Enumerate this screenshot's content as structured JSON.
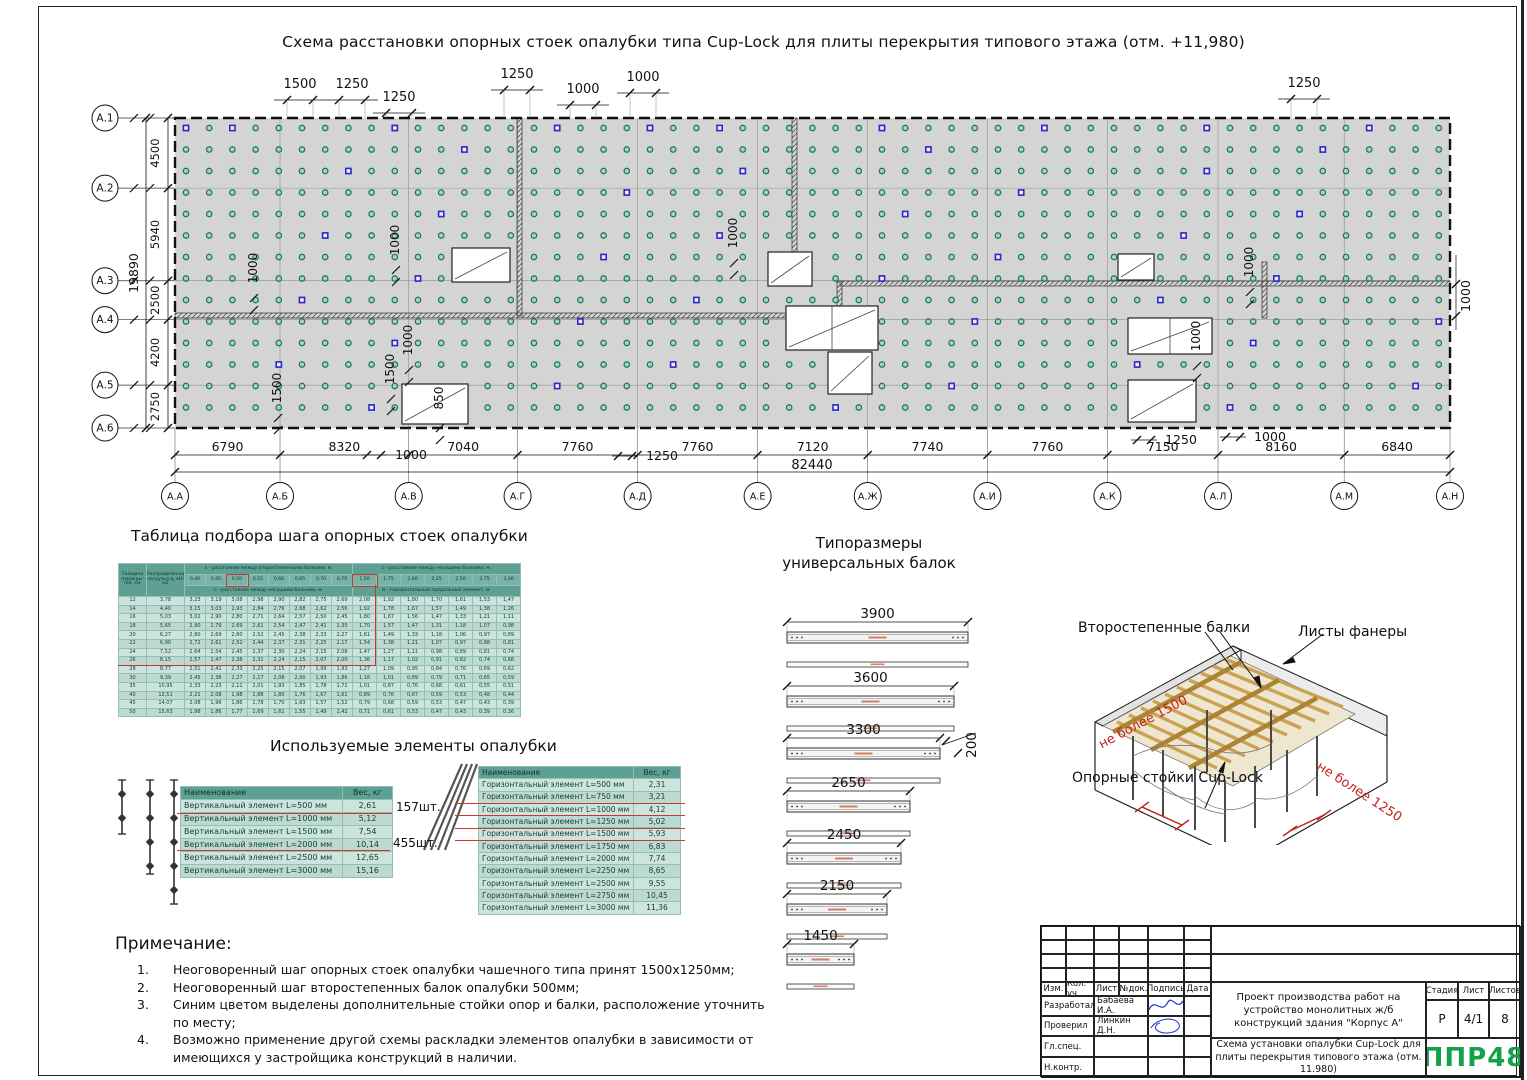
{
  "sheet": {
    "title": "Схема расстановки опорных стоек опалубки типа Cup-Lock для плиты перекрытия типового этажа (отм. +11,980)"
  },
  "colors": {
    "plate_gray": "#d4d4d2",
    "support_green_stroke": "#1f7a58",
    "support_green_fill": "#a8d4c2",
    "extra_blue": "#2a2ac8",
    "table_header": "#5fa095",
    "highlight_red": "#c23b2e",
    "logo_green": "#15a04a"
  },
  "plan": {
    "col_labels": [
      "А.А",
      "А.Б",
      "А.В",
      "А.Г",
      "А.Д",
      "А.Е",
      "А.Ж",
      "А.И",
      "А.К",
      "А.Л",
      "А.М",
      "А.Н"
    ],
    "col_spans": [
      "6790",
      "8320",
      "7040",
      "7760",
      "7760",
      "7120",
      "7740",
      "7760",
      "7150",
      "8160",
      "6840"
    ],
    "total_width": "82440",
    "row_labels": [
      "А.1",
      "А.2",
      "А.3",
      "А.4",
      "А.5",
      "А.6"
    ],
    "row_spans": [
      "4500",
      "5940",
      "2500",
      "4200",
      "2750"
    ],
    "total_height": "19890",
    "top_dims": [
      {
        "label": "1500",
        "x": 300,
        "y": 88
      },
      {
        "label": "1250",
        "x": 352,
        "y": 88
      },
      {
        "label": "1250",
        "x": 399,
        "y": 101
      },
      {
        "label": "1250",
        "x": 517,
        "y": 78
      },
      {
        "label": "1000",
        "x": 583,
        "y": 93
      },
      {
        "label": "1000",
        "x": 643,
        "y": 81
      },
      {
        "label": "1250",
        "x": 1304,
        "y": 87
      }
    ],
    "inner_dims": [
      {
        "label": "1000",
        "x": 257,
        "y": 268
      },
      {
        "label": "1000",
        "x": 399,
        "y": 240
      },
      {
        "label": "1000",
        "x": 412,
        "y": 340
      },
      {
        "label": "1000",
        "x": 737,
        "y": 233
      },
      {
        "label": "1000",
        "x": 1253,
        "y": 262
      },
      {
        "label": "1000",
        "x": 1200,
        "y": 336
      },
      {
        "label": "1500",
        "x": 281,
        "y": 388
      },
      {
        "label": "1500",
        "x": 394,
        "y": 369
      },
      {
        "label": "850",
        "x": 443,
        "y": 398
      }
    ],
    "bottom_callouts": [
      {
        "label": "1000",
        "x": 397,
        "y": 451
      },
      {
        "label": "1250",
        "x": 648,
        "y": 452
      },
      {
        "label": "1250",
        "x": 1167,
        "y": 436
      },
      {
        "label": "1000",
        "x": 1256,
        "y": 433
      }
    ],
    "right_dim": "1000"
  },
  "step_table": {
    "title": "Таблица подбора шага опорных стоек опалубки",
    "head_col1": "Толщина перекры- тия, см.",
    "head_col2": "Распределенная нагрузка q, кН/ м2",
    "group_a": "a -  расстояние между второстепенными балками, м.",
    "group_c": "c -  расстояние между несущими балками, м.",
    "sub_a": "c - расстояние между несущими балками, м.",
    "sub_c": "b - горизонтальный продольный элемент, м.",
    "a_cols": [
      "0,40",
      "0,45",
      "0,50",
      "0,55",
      "0,60",
      "0,65",
      "0,70",
      "0,75"
    ],
    "c_cols": [
      "1,50",
      "1,75",
      "2,00",
      "2,25",
      "2,50",
      "2,75",
      "3,00"
    ],
    "rows": [
      {
        "t": "12",
        "q": "3,78",
        "a": [
          "3,23",
          "3,19",
          "3,08",
          "2,98",
          "2,90",
          "2,82",
          "2,75",
          "2,69"
        ],
        "c": [
          "2,08",
          "1,92",
          "1,80",
          "1,70",
          "1,61",
          "1,53",
          "1,47"
        ]
      },
      {
        "t": "14",
        "q": "4,40",
        "a": [
          "3,15",
          "3,03",
          "2,93",
          "2,84",
          "2,76",
          "2,68",
          "2,62",
          "2,56"
        ],
        "c": [
          "1,92",
          "1,78",
          "1,67",
          "1,57",
          "1,49",
          "1,38",
          "1,26"
        ]
      },
      {
        "t": "16",
        "q": "5,03",
        "a": [
          "3,02",
          "2,90",
          "2,80",
          "2,71",
          "2,64",
          "2,57",
          "2,50",
          "2,45"
        ],
        "c": [
          "1,80",
          "1,67",
          "1,56",
          "1,47",
          "1,33",
          "1,21",
          "1,11"
        ]
      },
      {
        "t": "18",
        "q": "5,65",
        "a": [
          "2,90",
          "2,79",
          "2,69",
          "2,61",
          "2,54",
          "2,47",
          "2,41",
          "2,35"
        ],
        "c": [
          "1,70",
          "1,57",
          "1,47",
          "1,31",
          "1,18",
          "1,07",
          "0,98"
        ]
      },
      {
        "t": "20",
        "q": "6,27",
        "a": [
          "2,80",
          "2,69",
          "2,60",
          "2,52",
          "2,45",
          "2,38",
          "2,33",
          "2,27"
        ],
        "c": [
          "1,61",
          "1,49",
          "1,33",
          "1,18",
          "1,06",
          "0,97",
          "0,89"
        ]
      },
      {
        "t": "22",
        "q": "6,90",
        "a": [
          "2,72",
          "2,61",
          "2,52",
          "2,44",
          "2,37",
          "2,31",
          "2,25",
          "2,17"
        ],
        "c": [
          "1,54",
          "1,38",
          "1,21",
          "1,07",
          "0,97",
          "0,88",
          "0,81"
        ]
      },
      {
        "t": "24",
        "q": "7,52",
        "a": [
          "2,64",
          "2,54",
          "2,45",
          "2,37",
          "2,30",
          "2,24",
          "2,15",
          "2,08"
        ],
        "c": [
          "1,47",
          "1,27",
          "1,11",
          "0,98",
          "0,89",
          "0,81",
          "0,74"
        ]
      },
      {
        "t": "26",
        "q": "8,15",
        "a": [
          "2,57",
          "2,47",
          "2,38",
          "2,31",
          "2,24",
          "2,15",
          "2,07",
          "2,00"
        ],
        "c": [
          "1,36",
          "1,17",
          "1,02",
          "0,91",
          "0,82",
          "0,74",
          "0,68"
        ]
      },
      {
        "t": "28",
        "q": "8,77",
        "a": [
          "2,51",
          "2,41",
          "2,33",
          "2,25",
          "2,15",
          "2,07",
          "1,99",
          "1,93"
        ],
        "c": [
          "1,27",
          "1,09",
          "0,95",
          "0,84",
          "0,76",
          "0,69",
          "0,62"
        ]
      },
      {
        "t": "30",
        "q": "9,39",
        "a": [
          "2,45",
          "2,36",
          "2,27",
          "2,17",
          "2,08",
          "2,00",
          "1,93",
          "1,86"
        ],
        "c": [
          "1,18",
          "1,01",
          "0,89",
          "0,79",
          "0,71",
          "0,65",
          "0,59"
        ]
      },
      {
        "t": "35",
        "q": "10,95",
        "a": [
          "2,33",
          "2,23",
          "2,11",
          "2,01",
          "1,93",
          "1,85",
          "1,78",
          "1,72"
        ],
        "c": [
          "1,01",
          "0,87",
          "0,76",
          "0,68",
          "0,61",
          "0,55",
          "0,51"
        ]
      },
      {
        "t": "40",
        "q": "12,51",
        "a": [
          "2,21",
          "2,08",
          "1,98",
          "1,88",
          "1,80",
          "1,76",
          "1,67",
          "1,61"
        ],
        "c": [
          "0,89",
          "0,76",
          "0,67",
          "0,59",
          "0,53",
          "0,48",
          "0,44"
        ]
      },
      {
        "t": "45",
        "q": "14,07",
        "a": [
          "2,08",
          "1,96",
          "1,86",
          "1,78",
          "1,70",
          "1,63",
          "1,57",
          "1,52"
        ],
        "c": [
          "0,79",
          "0,68",
          "0,59",
          "0,53",
          "0,47",
          "0,43",
          "0,39"
        ]
      },
      {
        "t": "50",
        "q": "15,63",
        "a": [
          "1,98",
          "1,86",
          "1,77",
          "1,69",
          "1,61",
          "1,55",
          "1,49",
          "1,42"
        ],
        "c": [
          "0,71",
          "0,61",
          "0,53",
          "0,47",
          "0,43",
          "0,39",
          "0,36"
        ]
      }
    ]
  },
  "elements": {
    "title": "Используемые элементы опалубки",
    "vertical": {
      "headers": [
        "Наименование",
        "Вес, кг"
      ],
      "rows": [
        [
          "Вертикальный элемент L=500 мм",
          "2,61"
        ],
        [
          "Вертикальный элемент L=1000 мм",
          "5,12"
        ],
        [
          "Вертикальный элемент L=1500 мм",
          "7,54"
        ],
        [
          "Вертикальный элемент L=2000 мм",
          "10,14"
        ],
        [
          "Вертикальный элемент L=2500 мм",
          "12,65"
        ],
        [
          "Вертикальный элемент L=3000 мм",
          "15,16"
        ]
      ],
      "count_1": "157шт.",
      "count_2": "455шт."
    },
    "horizontal": {
      "headers": [
        "Наименование",
        "Вес, кг"
      ],
      "rows": [
        [
          "Горизонтальный элемент L=500 мм",
          "2,31"
        ],
        [
          "Горизонтальный элемент L=750 мм",
          "3,21"
        ],
        [
          "Горизонтальный элемент L=1000 мм",
          "4,12"
        ],
        [
          "Горизонтальный элемент L=1250 мм",
          "5,02"
        ],
        [
          "Горизонтальный элемент L=1500 мм",
          "5,93"
        ],
        [
          "Горизонтальный элемент L=1750 мм",
          "6,83"
        ],
        [
          "Горизонтальный элемент L=2000 мм",
          "7,74"
        ],
        [
          "Горизонтальный элемент L=2250 мм",
          "8,65"
        ],
        [
          "Горизонтальный элемент L=2500 мм",
          "9,55"
        ],
        [
          "Горизонтальный элемент L=2750 мм",
          "10,45"
        ],
        [
          "Горизонтальный элемент L=3000 мм",
          "11,36"
        ]
      ]
    }
  },
  "beams": {
    "title": "Типоразмеры универсальных балок",
    "lengths": [
      "3900",
      "3600",
      "3300",
      "2650",
      "2450",
      "2150",
      "1450"
    ],
    "height_dim": "200"
  },
  "axon": {
    "secondary": "Второстепенные балки",
    "plywood": "Листы фанеры",
    "posts": "Опорные стойки Cup-Lock",
    "max1": "не более 1500",
    "max2": "не более 1250"
  },
  "notes": {
    "title": "Примечание:",
    "items": [
      {
        "num": "1.",
        "text": "Неоговоренный шаг опорных стоек опалубки чашечного типа принят 1500х1250мм;"
      },
      {
        "num": "2.",
        "text": "Неоговоренный шаг второстепенных балок опалубки 500мм;"
      },
      {
        "num": "3.",
        "text": "Синим цветом выделены дополнительные стойки опор и балки, расположение уточнить по месту;"
      },
      {
        "num": "4.",
        "text": "Возможно применение другой схемы раскладки элементов опалубки в зависимости от имеющихся у застройщика конструкций в наличии."
      }
    ]
  },
  "titleblock": {
    "cols": [
      "Изм.",
      "Кол. уч",
      "Лист",
      "№док.",
      "Подпись",
      "Дата"
    ],
    "sign_rows": [
      [
        "Разработал",
        "Бабаева И.А."
      ],
      [
        "Проверил",
        "Линкин Д.Н."
      ],
      [
        "Гл.спец.",
        ""
      ],
      [
        "Н.контр.",
        ""
      ]
    ],
    "project": "Проект производства работ на устройство монолитных ж/б конструкций здания \"Корпус А\"",
    "stage_label": "Стадия",
    "sheet_label": "Лист",
    "sheets_label": "Листов",
    "stage": "Р",
    "sheet": "4/1",
    "sheets": "8",
    "doc_title": "Схема установки опалубки Cup-Lock для плиты перекрытия типового этажа (отм. 11.980)",
    "logo": "ППР48"
  }
}
